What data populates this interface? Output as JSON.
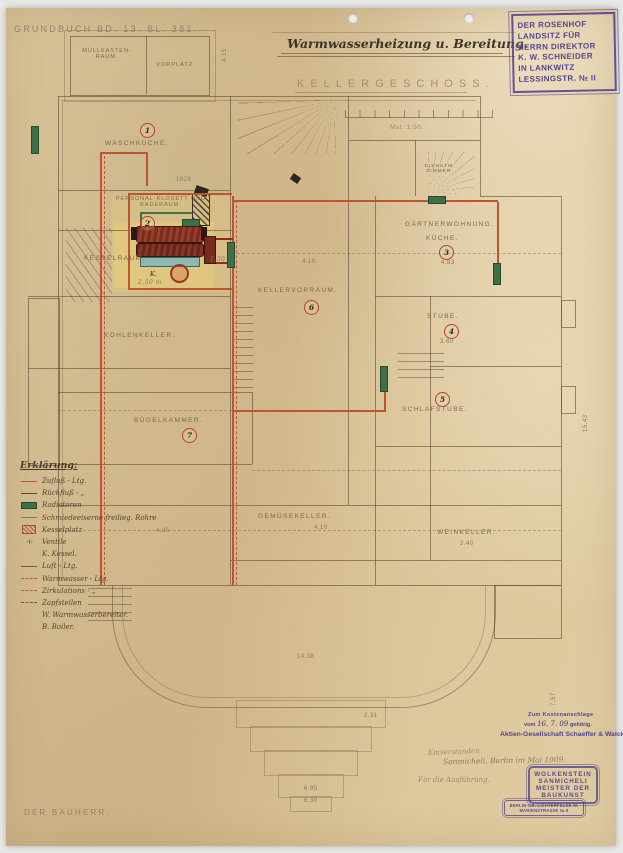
{
  "document": {
    "grundbuch": "GRUNDBUCH BD. 13. BL. 381.",
    "title": "Warmwasserheizung u. Bereitung.",
    "floor_label": "KELLERGESCHOSS.",
    "scale_note": "Mst. 1:50.",
    "bauherr": "DER BAUHERR."
  },
  "owner_stamp": {
    "lines": [
      "DER ROSENHOF",
      "LANDSITZ FÜR",
      "HERRN DIREKTOR",
      "K. W. SCHNEIDER",
      "IN LANKWITZ",
      "LESSINGSTR. № II"
    ]
  },
  "rooms": [
    {
      "label": "MÜLLKASTEN-RAUM."
    },
    {
      "label": "VORPLATZ."
    },
    {
      "label": "WASCHKÜCHE.",
      "number": "1"
    },
    {
      "label": "PERSONAL-KLOSETT UND BADERAUM.",
      "number": "2"
    },
    {
      "label": "KESSELRAUM."
    },
    {
      "label": "KOHLENKELLER."
    },
    {
      "label": "BÜGELKAMMER.",
      "number": "7"
    },
    {
      "label": "KELLERVORRAUM.",
      "number": "6",
      "dim": "4.10"
    },
    {
      "label": "GÄRTNERWOHNUNG."
    },
    {
      "label": "KÜCHE.",
      "number": "3",
      "dim": "4.83"
    },
    {
      "label": "STUBE.",
      "number": "4",
      "dim": "3.60"
    },
    {
      "label": "SCHLAFSTUBE.",
      "number": "5"
    },
    {
      "label": "GEMÜSEKELLER.",
      "dim": "4.10"
    },
    {
      "label": "WEINKELLER.",
      "dim": "2.40"
    },
    {
      "label": "DIENSTM. ZIMMER."
    }
  ],
  "boiler": {
    "label": "K.",
    "length_note": "2,50 m",
    "diameter_note": "1,30"
  },
  "dims": [
    "4.15",
    "1628.",
    "15.43",
    "14.38",
    "7.57",
    "2.31",
    "6.95",
    "6.30",
    "4.85"
  ],
  "icons": {
    "valve": "◁▷"
  },
  "legend": {
    "title": "Erklärung:",
    "items": [
      {
        "label": "Zufluß - Ltg."
      },
      {
        "label": "Rückfluß - „"
      },
      {
        "label": "Radiatoren"
      },
      {
        "label": "Schmiedeeiserne freilieg. Rohre"
      },
      {
        "label": "Kesselplatz"
      },
      {
        "label": "Ventile"
      },
      {
        "label": "K. Kessel."
      },
      {
        "label": "Luft - Ltg."
      },
      {
        "label": "Warmwasser - Ltg."
      },
      {
        "label": "Zirkulations - „"
      },
      {
        "label": "Zapfstellen"
      },
      {
        "label": "W. Warmwasserbereiter."
      },
      {
        "label": "B. Boiler."
      }
    ]
  },
  "approval": {
    "cost_stamp_line1": "Zum Kostenanschlage",
    "cost_stamp_vom": "vom",
    "cost_stamp_date": "16. 7. 09",
    "cost_stamp_suffix": "gehörig.",
    "company": "Aktien-Gesellschaft Schaeffer & Walcker",
    "hw_agreed": "Einverstanden",
    "hw_signature": "Sanmicheli,  Berlin im Mai 1909.",
    "hw_execution": "Für die Ausführung.",
    "architect_stamp_lines": [
      "WOLKENSTEIN",
      "SANMICHELI",
      "MEISTER DER",
      "BAUKUNST"
    ],
    "address_stamp_lines": [
      "BERLIN-GR. LICHTERFELDE W.",
      "MARIENSTRASSE № 9"
    ]
  }
}
